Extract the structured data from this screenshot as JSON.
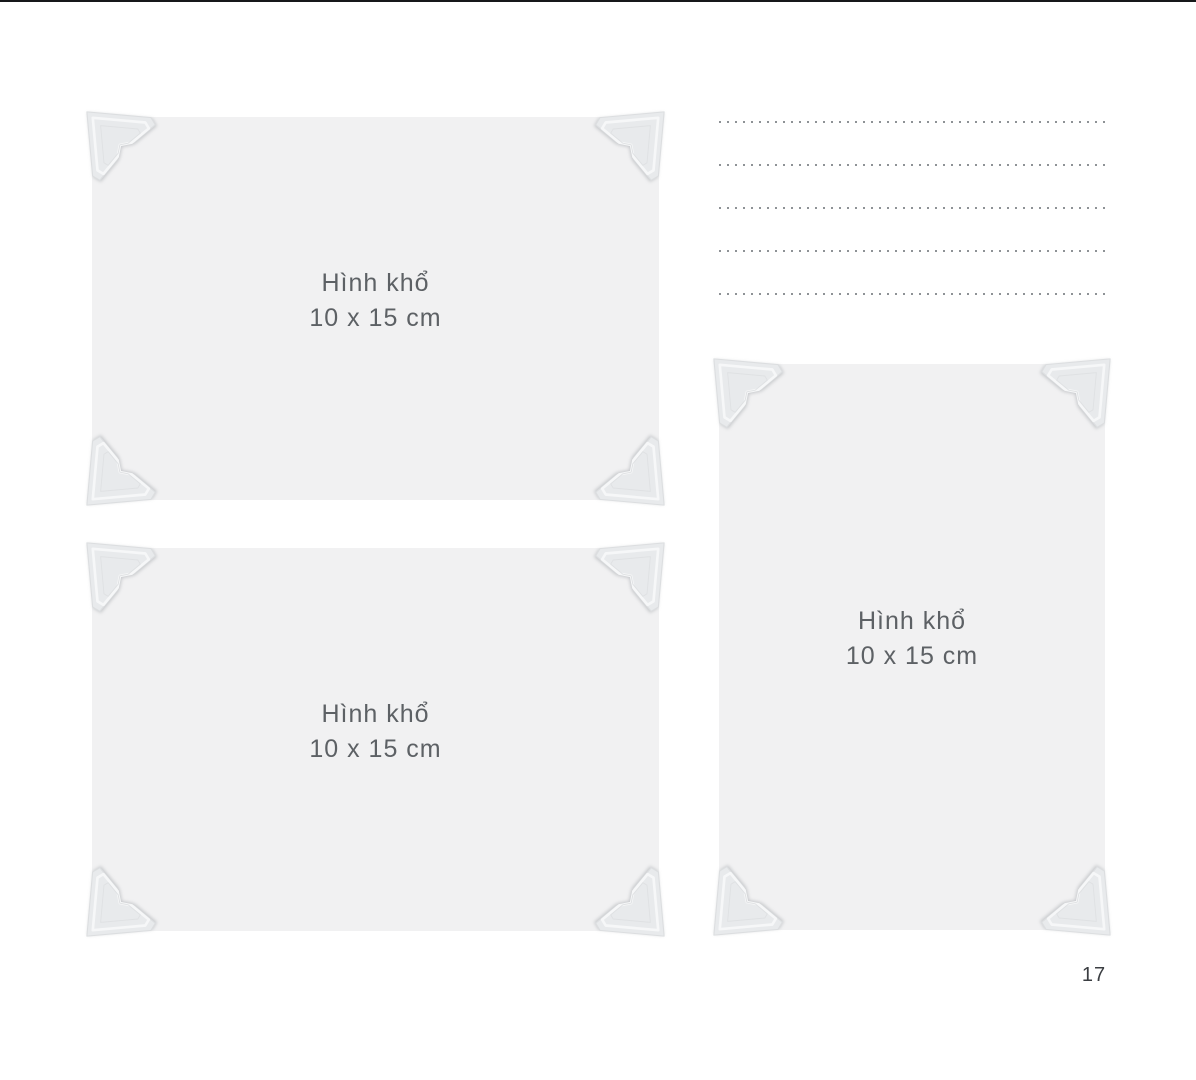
{
  "page": {
    "number": "17",
    "background_color": "#ffffff",
    "top_edge_color": "#17181a"
  },
  "photo_slots": [
    {
      "orientation": "landscape",
      "label_line1": "Hình khổ",
      "label_line2": "10 x 15 cm"
    },
    {
      "orientation": "landscape",
      "label_line1": "Hình khổ",
      "label_line2": "10 x 15 cm"
    },
    {
      "orientation": "portrait",
      "label_line1": "Hình khổ",
      "label_line2": "10 x 15 cm"
    }
  ],
  "notes": {
    "line_count": 5,
    "line_style": "dotted"
  },
  "colors": {
    "photo_placeholder": "#f1f1f2",
    "corner_mount": "#e8eaec",
    "corner_mount_highlight": "#f6f7f8",
    "dotted_line": "#8e9296",
    "label_text": "#5d6165",
    "page_number_text": "#3b3e42"
  }
}
